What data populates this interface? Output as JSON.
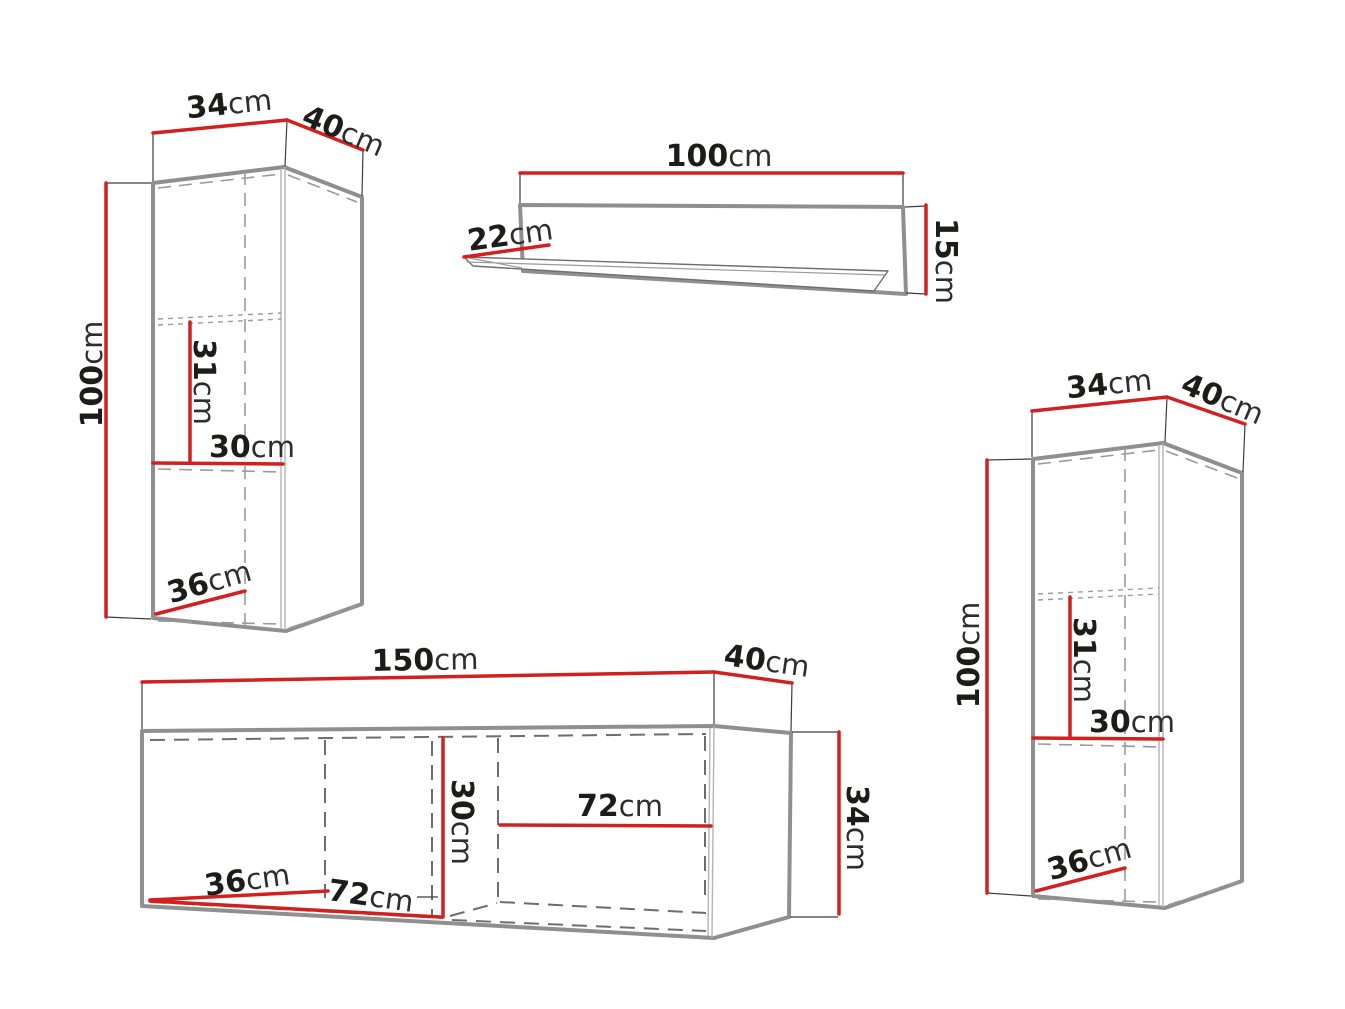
{
  "diagram": {
    "title": "furniture-set-dimension-diagram",
    "unit": "cm",
    "colors": {
      "dimension_red": "#d2201f",
      "outline_gray": "#8f8f8f",
      "dashed_gray": "#9a9a9a",
      "text_black": "#1c1c1b",
      "background": "#ffffff"
    },
    "pieces": {
      "cabinet_left": {
        "name": "hanging-cabinet-left",
        "width": "34",
        "depth": "40",
        "height": "100",
        "inner_height": "31",
        "inner_width": "30",
        "inner_depth": "36"
      },
      "shelf": {
        "name": "wall-shelf",
        "width": "100",
        "depth": "22",
        "height": "15"
      },
      "cabinet_right": {
        "name": "hanging-cabinet-right",
        "width": "34",
        "depth": "40",
        "height": "100",
        "inner_height": "31",
        "inner_width": "30",
        "inner_depth": "36"
      },
      "tv_stand": {
        "name": "tv-stand",
        "width": "150",
        "depth": "40",
        "height": "34",
        "inner_height": "30",
        "left_inner_width": "72",
        "right_inner_width": "72",
        "inner_depth": "36"
      }
    }
  }
}
